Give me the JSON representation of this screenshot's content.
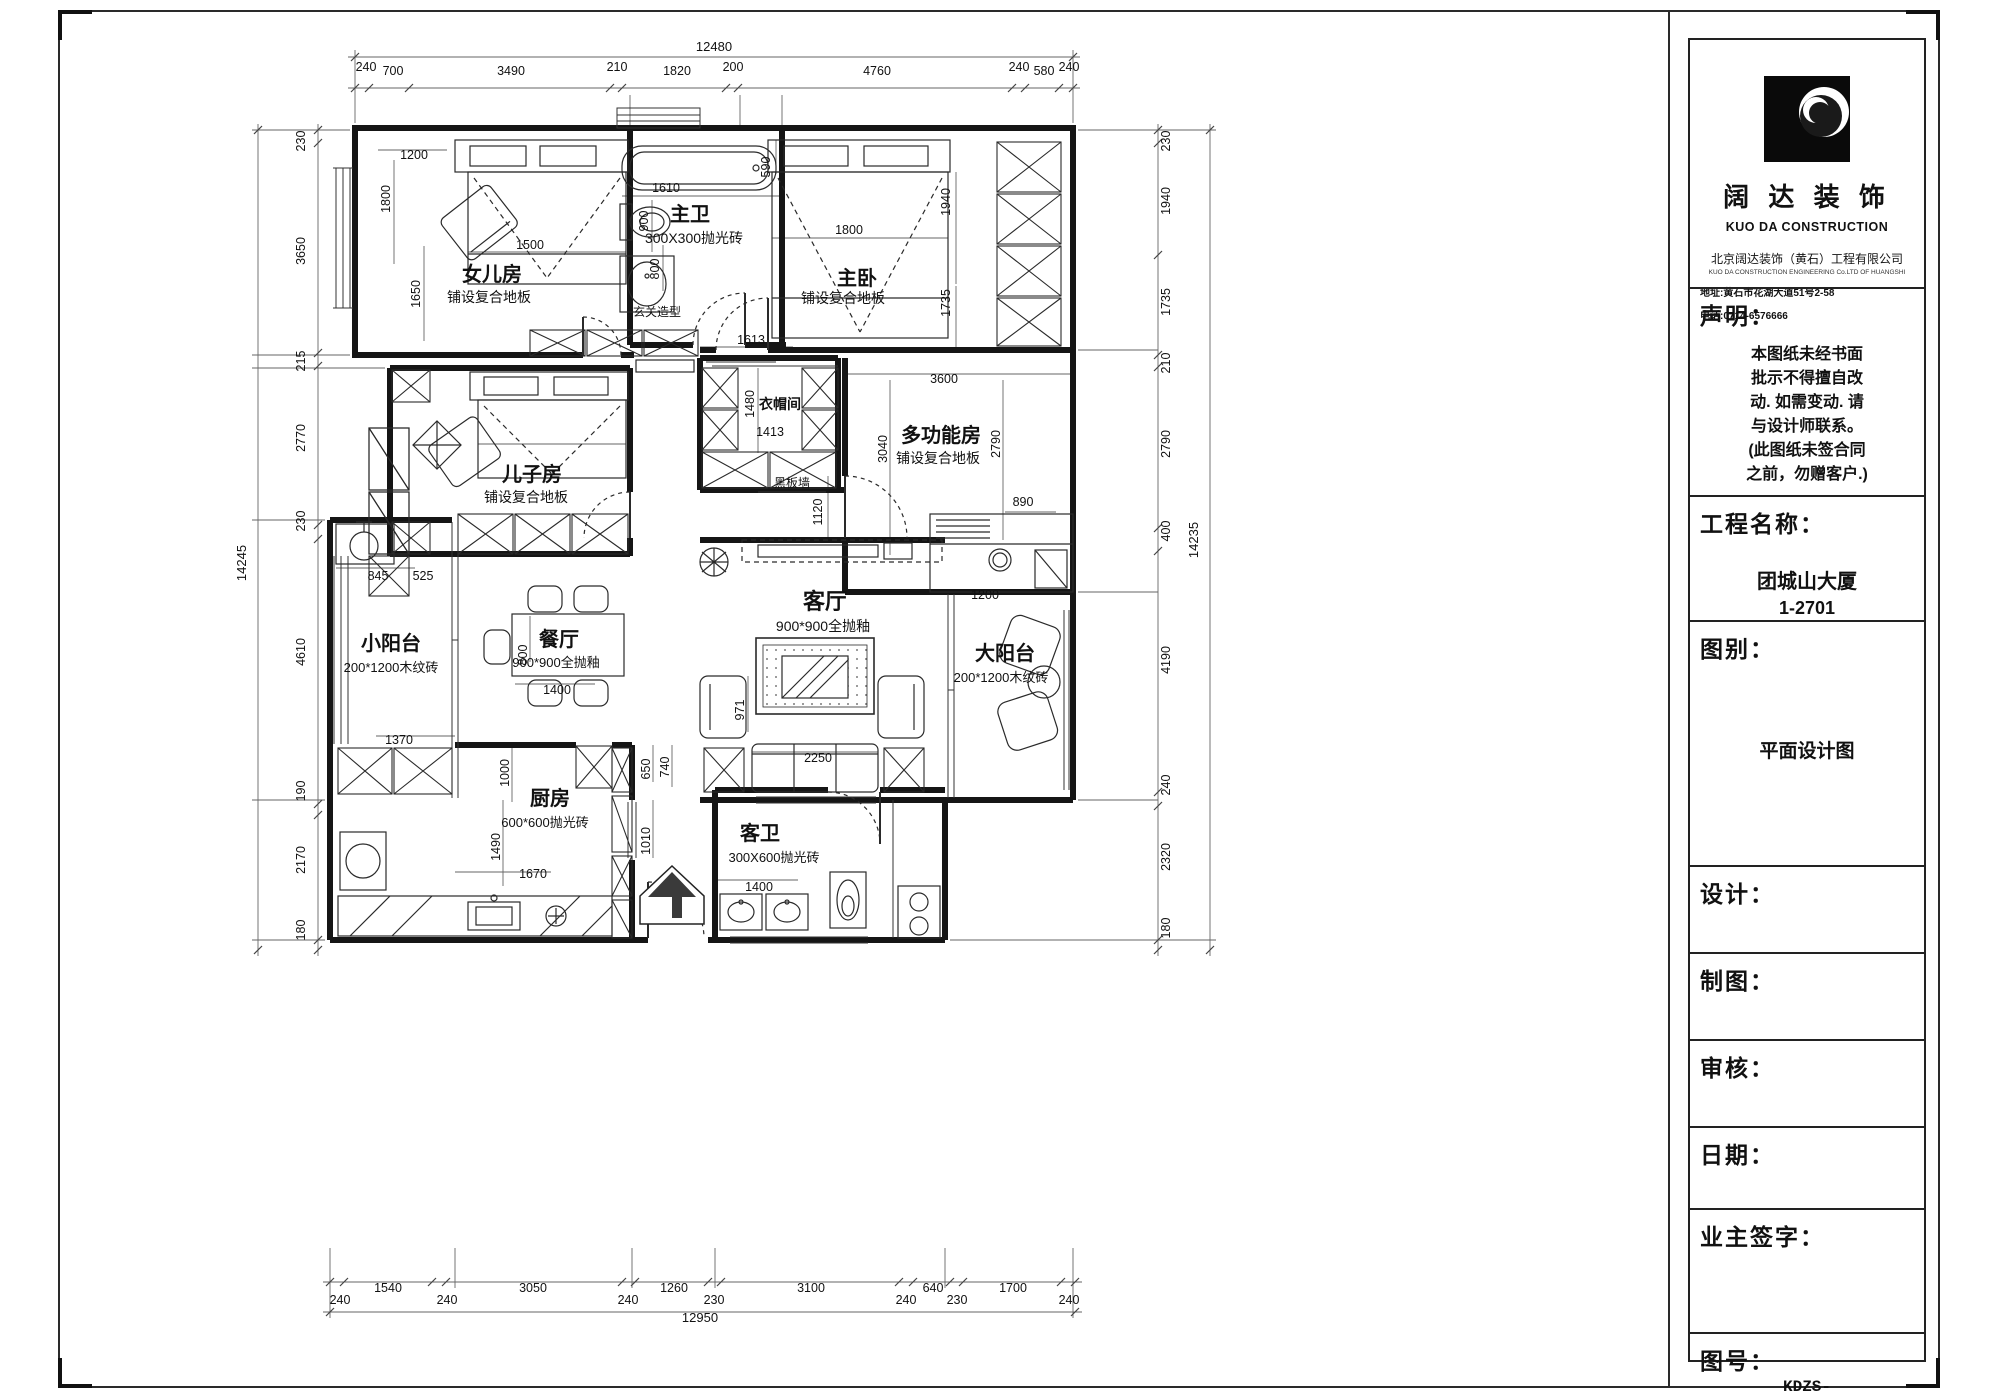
{
  "sheet": {
    "title_block": {
      "brand": "阔 达 装 饰",
      "brand_en": "KUO DA CONSTRUCTION",
      "company": "北京阔达装饰（黄石）工程有限公司",
      "company_en": "KUO DA CONSTRUCTION ENGINEERING Co.LTD OF HUANGSHI",
      "address": "地址:黄石市花湖大道51号2-58",
      "phone": "电话:0714-6576666",
      "declaration_title": "声明：",
      "declaration_lines": [
        "本图纸未经书面",
        "批示不得擅自改",
        "动. 如需变动. 请",
        "与设计师联系。",
        "(此图纸未签合同",
        "之前，勿赠客户.)"
      ],
      "project_label": "工程名称：",
      "project_name": "团城山大厦",
      "project_no": "1-2701",
      "drawing_type_label": "图别：",
      "drawing_type": "平面设计图",
      "designer_label": "设计：",
      "drafter_label": "制图：",
      "checker_label": "审核：",
      "date_label": "日期：",
      "owner_sign_label": "业主签字：",
      "drawing_no_label": "图号：",
      "drawing_no": "KDZS-"
    }
  },
  "plan": {
    "labels": [
      {
        "t": "女儿房",
        "x": 492,
        "y": 281,
        "s": 20,
        "b": 1,
        "n": "room-label"
      },
      {
        "t": "铺设复合地板",
        "x": 489,
        "y": 302,
        "s": 14,
        "n": "room-subtitle"
      },
      {
        "t": "主卫",
        "x": 690,
        "y": 221,
        "s": 20,
        "b": 1,
        "n": "room-label"
      },
      {
        "t": "300X300抛光砖",
        "x": 694,
        "y": 243,
        "s": 14,
        "n": "room-subtitle"
      },
      {
        "t": "主卧",
        "x": 857,
        "y": 285,
        "s": 20,
        "b": 1,
        "n": "room-label"
      },
      {
        "t": "铺设复合地板",
        "x": 843,
        "y": 303,
        "s": 14,
        "n": "room-subtitle"
      },
      {
        "t": "玄关造型",
        "x": 657,
        "y": 316,
        "s": 12,
        "n": "feature-label"
      },
      {
        "t": "儿子房",
        "x": 532,
        "y": 481,
        "s": 20,
        "b": 1,
        "n": "room-label"
      },
      {
        "t": "铺设复合地板",
        "x": 526,
        "y": 502,
        "s": 14,
        "n": "room-subtitle"
      },
      {
        "t": "衣帽间",
        "x": 780,
        "y": 409,
        "s": 14,
        "b": 1,
        "n": "room-label"
      },
      {
        "t": "多功能房",
        "x": 941,
        "y": 442,
        "s": 20,
        "b": 1,
        "n": "room-label"
      },
      {
        "t": "铺设复合地板",
        "x": 938,
        "y": 463,
        "s": 14,
        "n": "room-subtitle"
      },
      {
        "t": "黑板墙",
        "x": 792,
        "y": 487,
        "s": 12,
        "n": "feature-label"
      },
      {
        "t": "小阳台",
        "x": 391,
        "y": 650,
        "s": 20,
        "b": 1,
        "n": "room-label"
      },
      {
        "t": "200*1200木纹砖",
        "x": 391,
        "y": 672,
        "s": 13,
        "n": "room-subtitle"
      },
      {
        "t": "餐厅",
        "x": 559,
        "y": 646,
        "s": 20,
        "b": 1,
        "n": "room-label"
      },
      {
        "t": "900*900全抛釉",
        "x": 556,
        "y": 667,
        "s": 13,
        "n": "room-subtitle"
      },
      {
        "t": "客厅",
        "x": 825,
        "y": 609,
        "s": 22,
        "b": 1,
        "n": "room-label"
      },
      {
        "t": "900*900全抛釉",
        "x": 823,
        "y": 631,
        "s": 14,
        "n": "room-subtitle"
      },
      {
        "t": "大阳台",
        "x": 1005,
        "y": 660,
        "s": 20,
        "b": 1,
        "n": "room-label"
      },
      {
        "t": "200*1200木纹砖",
        "x": 1001,
        "y": 682,
        "s": 13,
        "n": "room-subtitle"
      },
      {
        "t": "厨房",
        "x": 550,
        "y": 805,
        "s": 20,
        "b": 1,
        "n": "room-label"
      },
      {
        "t": "600*600抛光砖",
        "x": 545,
        "y": 827,
        "s": 13,
        "n": "room-subtitle"
      },
      {
        "t": "客卫",
        "x": 760,
        "y": 840,
        "s": 20,
        "b": 1,
        "n": "room-label"
      },
      {
        "t": "300X600抛光砖",
        "x": 774,
        "y": 862,
        "s": 13,
        "n": "room-subtitle"
      },
      {
        "t": "12480",
        "x": 714,
        "y": 51,
        "s": 13,
        "n": "dim-label"
      },
      {
        "t": "240",
        "x": 366,
        "y": 71,
        "s": 12.5,
        "n": "dim-label"
      },
      {
        "t": "700",
        "x": 393,
        "y": 75,
        "s": 12.5,
        "n": "dim-label"
      },
      {
        "t": "3490",
        "x": 511,
        "y": 75,
        "s": 12.5,
        "n": "dim-label"
      },
      {
        "t": "210",
        "x": 617,
        "y": 71,
        "s": 12.5,
        "n": "dim-label"
      },
      {
        "t": "1820",
        "x": 677,
        "y": 75,
        "s": 12.5,
        "n": "dim-label"
      },
      {
        "t": "200",
        "x": 733,
        "y": 71,
        "s": 12.5,
        "n": "dim-label"
      },
      {
        "t": "4760",
        "x": 877,
        "y": 75,
        "s": 12.5,
        "n": "dim-label"
      },
      {
        "t": "240",
        "x": 1019,
        "y": 71,
        "s": 12.5,
        "n": "dim-label"
      },
      {
        "t": "580",
        "x": 1044,
        "y": 75,
        "s": 12.5,
        "n": "dim-label"
      },
      {
        "t": "240",
        "x": 1069,
        "y": 71,
        "s": 12.5,
        "n": "dim-label"
      },
      {
        "t": "14245",
        "x": 246,
        "y": 563,
        "s": 13,
        "r": -90,
        "n": "dim-label"
      },
      {
        "t": "230",
        "x": 305,
        "y": 141,
        "s": 12.5,
        "r": -90,
        "n": "dim-label"
      },
      {
        "t": "3650",
        "x": 305,
        "y": 251,
        "s": 12.5,
        "r": -90,
        "n": "dim-label"
      },
      {
        "t": "215",
        "x": 305,
        "y": 361,
        "s": 12.5,
        "r": -90,
        "n": "dim-label"
      },
      {
        "t": "2770",
        "x": 305,
        "y": 438,
        "s": 12.5,
        "r": -90,
        "n": "dim-label"
      },
      {
        "t": "230",
        "x": 305,
        "y": 521,
        "s": 12.5,
        "r": -90,
        "n": "dim-label"
      },
      {
        "t": "4610",
        "x": 305,
        "y": 652,
        "s": 12.5,
        "r": -90,
        "n": "dim-label"
      },
      {
        "t": "190",
        "x": 305,
        "y": 791,
        "s": 12.5,
        "r": -90,
        "n": "dim-label"
      },
      {
        "t": "2170",
        "x": 305,
        "y": 860,
        "s": 12.5,
        "r": -90,
        "n": "dim-label"
      },
      {
        "t": "180",
        "x": 305,
        "y": 930,
        "s": 12.5,
        "r": -90,
        "n": "dim-label"
      },
      {
        "t": "14235",
        "x": 1198,
        "y": 540,
        "s": 13,
        "r": -90,
        "n": "dim-label"
      },
      {
        "t": "230",
        "x": 1170,
        "y": 141,
        "s": 12.5,
        "r": -90,
        "n": "dim-label"
      },
      {
        "t": "1940",
        "x": 1170,
        "y": 201,
        "s": 12.5,
        "r": -90,
        "n": "dim-label"
      },
      {
        "t": "1735",
        "x": 1170,
        "y": 302,
        "s": 12.5,
        "r": -90,
        "n": "dim-label"
      },
      {
        "t": "210",
        "x": 1170,
        "y": 363,
        "s": 12.5,
        "r": -90,
        "n": "dim-label"
      },
      {
        "t": "2790",
        "x": 1170,
        "y": 444,
        "s": 12.5,
        "r": -90,
        "n": "dim-label"
      },
      {
        "t": "400",
        "x": 1170,
        "y": 531,
        "s": 12.5,
        "r": -90,
        "n": "dim-label"
      },
      {
        "t": "4190",
        "x": 1170,
        "y": 660,
        "s": 12.5,
        "r": -90,
        "n": "dim-label"
      },
      {
        "t": "240",
        "x": 1170,
        "y": 785,
        "s": 12.5,
        "r": -90,
        "n": "dim-label"
      },
      {
        "t": "2320",
        "x": 1170,
        "y": 857,
        "s": 12.5,
        "r": -90,
        "n": "dim-label"
      },
      {
        "t": "180",
        "x": 1170,
        "y": 928,
        "s": 12.5,
        "r": -90,
        "n": "dim-label"
      },
      {
        "t": "12950",
        "x": 700,
        "y": 1322,
        "s": 13,
        "n": "dim-label"
      },
      {
        "t": "240",
        "x": 340,
        "y": 1304,
        "s": 12.5,
        "n": "dim-label"
      },
      {
        "t": "1540",
        "x": 388,
        "y": 1292,
        "s": 12.5,
        "n": "dim-label"
      },
      {
        "t": "240",
        "x": 447,
        "y": 1304,
        "s": 12.5,
        "n": "dim-label"
      },
      {
        "t": "3050",
        "x": 533,
        "y": 1292,
        "s": 12.5,
        "n": "dim-label"
      },
      {
        "t": "240",
        "x": 628,
        "y": 1304,
        "s": 12.5,
        "n": "dim-label"
      },
      {
        "t": "1260",
        "x": 674,
        "y": 1292,
        "s": 12.5,
        "n": "dim-label"
      },
      {
        "t": "230",
        "x": 714,
        "y": 1304,
        "s": 12.5,
        "n": "dim-label"
      },
      {
        "t": "3100",
        "x": 811,
        "y": 1292,
        "s": 12.5,
        "n": "dim-label"
      },
      {
        "t": "240",
        "x": 906,
        "y": 1304,
        "s": 12.5,
        "n": "dim-label"
      },
      {
        "t": "640",
        "x": 933,
        "y": 1292,
        "s": 12.5,
        "n": "dim-label"
      },
      {
        "t": "230",
        "x": 957,
        "y": 1304,
        "s": 12.5,
        "n": "dim-label"
      },
      {
        "t": "1700",
        "x": 1013,
        "y": 1292,
        "s": 12.5,
        "n": "dim-label"
      },
      {
        "t": "240",
        "x": 1069,
        "y": 1304,
        "s": 12.5,
        "n": "dim-label"
      },
      {
        "t": "1200",
        "x": 414,
        "y": 159,
        "s": 12.5,
        "n": "dim-label"
      },
      {
        "t": "1800",
        "x": 390,
        "y": 199,
        "s": 12.5,
        "r": -90,
        "n": "dim-label"
      },
      {
        "t": "1650",
        "x": 420,
        "y": 294,
        "s": 12.5,
        "r": -90,
        "n": "dim-label"
      },
      {
        "t": "1500",
        "x": 530,
        "y": 249,
        "s": 12.5,
        "n": "dim-label"
      },
      {
        "t": "1610",
        "x": 666,
        "y": 192,
        "s": 12.5,
        "n": "dim-label"
      },
      {
        "t": "900",
        "x": 648,
        "y": 221,
        "s": 12.5,
        "r": -90,
        "n": "dim-label"
      },
      {
        "t": "800",
        "x": 659,
        "y": 269,
        "s": 12.5,
        "r": -90,
        "n": "dim-label"
      },
      {
        "t": "590",
        "x": 770,
        "y": 167,
        "s": 12.5,
        "r": -90,
        "n": "dim-label"
      },
      {
        "t": "1800",
        "x": 849,
        "y": 234,
        "s": 12.5,
        "n": "dim-label"
      },
      {
        "t": "1940",
        "x": 950,
        "y": 202,
        "s": 12.5,
        "r": -90,
        "n": "dim-label"
      },
      {
        "t": "1735",
        "x": 950,
        "y": 303,
        "s": 12.5,
        "r": -90,
        "n": "dim-label"
      },
      {
        "t": "1613",
        "x": 751,
        "y": 344,
        "s": 12.5,
        "n": "dim-label"
      },
      {
        "t": "1480",
        "x": 754,
        "y": 404,
        "s": 12.5,
        "r": -90,
        "n": "dim-label"
      },
      {
        "t": "1413",
        "x": 770,
        "y": 436,
        "s": 12.5,
        "n": "dim-label"
      },
      {
        "t": "1120",
        "x": 822,
        "y": 512,
        "s": 12.5,
        "r": -90,
        "n": "dim-label"
      },
      {
        "t": "3600",
        "x": 944,
        "y": 383,
        "s": 12.5,
        "n": "dim-label"
      },
      {
        "t": "3040",
        "x": 887,
        "y": 449,
        "s": 12.5,
        "r": -90,
        "n": "dim-label"
      },
      {
        "t": "2790",
        "x": 1000,
        "y": 444,
        "s": 12.5,
        "r": -90,
        "n": "dim-label"
      },
      {
        "t": "890",
        "x": 1023,
        "y": 506,
        "s": 12.5,
        "n": "dim-label"
      },
      {
        "t": "1200",
        "x": 985,
        "y": 599,
        "s": 12.5,
        "n": "dim-label"
      },
      {
        "t": "845",
        "x": 378,
        "y": 580,
        "s": 12.5,
        "n": "dim-label"
      },
      {
        "t": "525",
        "x": 423,
        "y": 580,
        "s": 12.5,
        "n": "dim-label"
      },
      {
        "t": "1370",
        "x": 399,
        "y": 744,
        "s": 12.5,
        "n": "dim-label"
      },
      {
        "t": "800",
        "x": 527,
        "y": 655,
        "s": 12.5,
        "r": -90,
        "n": "dim-label"
      },
      {
        "t": "1400",
        "x": 557,
        "y": 694,
        "s": 12.5,
        "n": "dim-label"
      },
      {
        "t": "971",
        "x": 744,
        "y": 710,
        "s": 12.5,
        "r": -90,
        "n": "dim-label"
      },
      {
        "t": "2250",
        "x": 818,
        "y": 762,
        "s": 12.5,
        "n": "dim-label"
      },
      {
        "t": "1000",
        "x": 509,
        "y": 773,
        "s": 12.5,
        "r": -90,
        "n": "dim-label"
      },
      {
        "t": "650",
        "x": 650,
        "y": 769,
        "s": 12.5,
        "r": -90,
        "n": "dim-label"
      },
      {
        "t": "740",
        "x": 669,
        "y": 767,
        "s": 12.5,
        "r": -90,
        "n": "dim-label"
      },
      {
        "t": "1490",
        "x": 500,
        "y": 847,
        "s": 12.5,
        "r": -90,
        "n": "dim-label"
      },
      {
        "t": "1010",
        "x": 650,
        "y": 841,
        "s": 12.5,
        "r": -90,
        "n": "dim-label"
      },
      {
        "t": "1670",
        "x": 533,
        "y": 878,
        "s": 12.5,
        "n": "dim-label"
      },
      {
        "t": "1400",
        "x": 759,
        "y": 891,
        "s": 12.5,
        "n": "dim-label"
      }
    ]
  }
}
